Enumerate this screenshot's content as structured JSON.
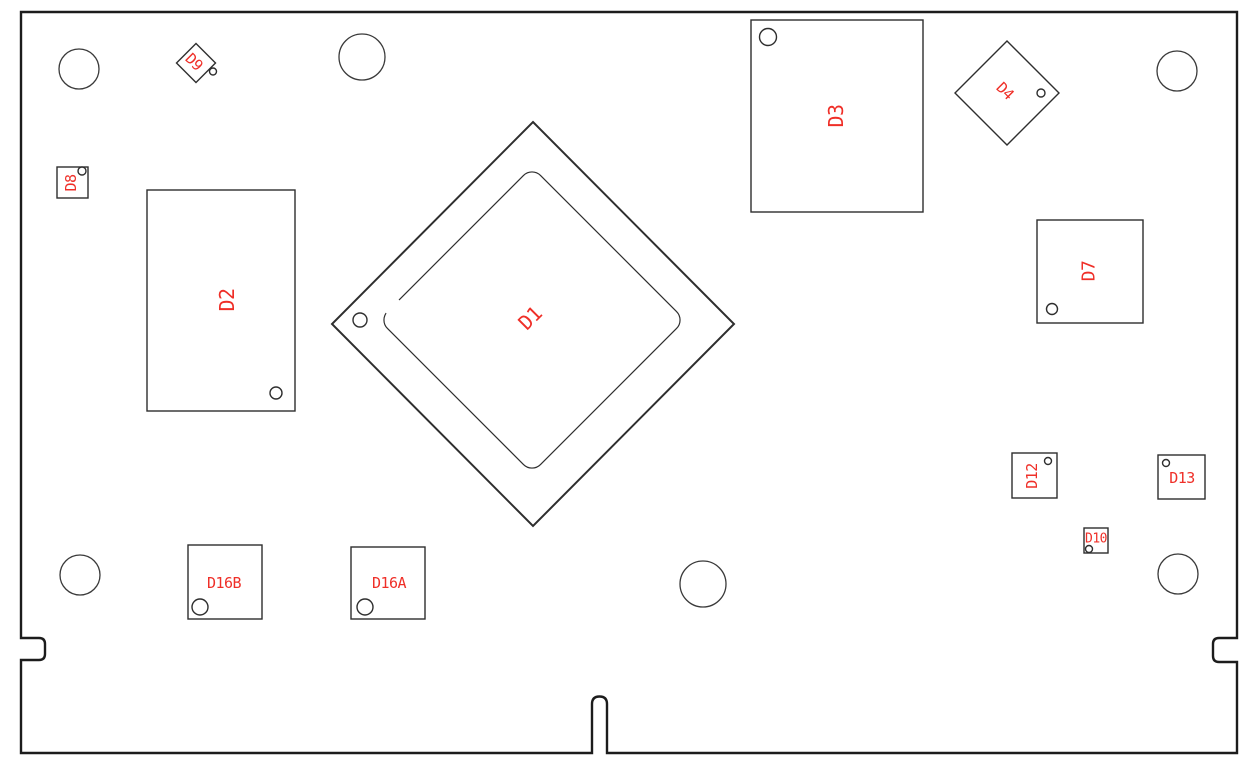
{
  "colors": {
    "background": "#ffffff",
    "outline": "#1c1c1c",
    "component_outline": "#2e2e2e",
    "hole_outline": "#3a3a3a",
    "designator": "#ef2f28"
  },
  "components": [
    {
      "ref": "D1",
      "shape": "large-diamond-package",
      "label_rotation": -45
    },
    {
      "ref": "D2",
      "shape": "rectangle",
      "label_rotation": -90
    },
    {
      "ref": "D3",
      "shape": "rectangle",
      "label_rotation": -90
    },
    {
      "ref": "D4",
      "shape": "diamond",
      "label_rotation": 45
    },
    {
      "ref": "D7",
      "shape": "square",
      "label_rotation": -90
    },
    {
      "ref": "D8",
      "shape": "small-square",
      "label_rotation": -90
    },
    {
      "ref": "D9",
      "shape": "small-diamond",
      "label_rotation": 45
    },
    {
      "ref": "D10",
      "shape": "small-square",
      "label_rotation": 0
    },
    {
      "ref": "D12",
      "shape": "small-square",
      "label_rotation": -90
    },
    {
      "ref": "D13",
      "shape": "small-square",
      "label_rotation": 0
    },
    {
      "ref": "D16A",
      "shape": "square",
      "label_rotation": 0
    },
    {
      "ref": "D16B",
      "shape": "square",
      "label_rotation": 0
    }
  ]
}
